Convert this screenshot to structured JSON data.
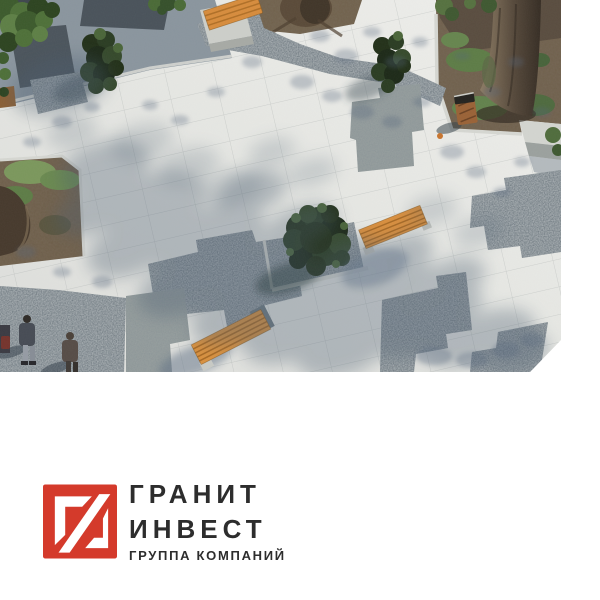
{
  "page": {
    "background": "#ffffff"
  },
  "hero": {
    "description": "Aerial photo of a renovated granite plaza: light paving with diagonal joints, dark granite-gravel insets, clipped evergreen shrubs, planting beds with trees, orange wooden benches, a litter bin and pedestrians, dappled tree shadows; bottom-right corner of the photo is bevel-cut",
    "elements": [
      "paving",
      "gravel-insets",
      "shrubs",
      "trees",
      "benches",
      "litter-bin",
      "pedestrians",
      "shadows"
    ]
  },
  "logo": {
    "mark": "granit-invest-monogram",
    "line1": "ГРАНИТ",
    "line2": "ИНВЕСТ",
    "tagline": "ГРУППА КОМПАНИЙ",
    "brand_red": "#d43a2b",
    "text_color": "#2d2d2d"
  }
}
